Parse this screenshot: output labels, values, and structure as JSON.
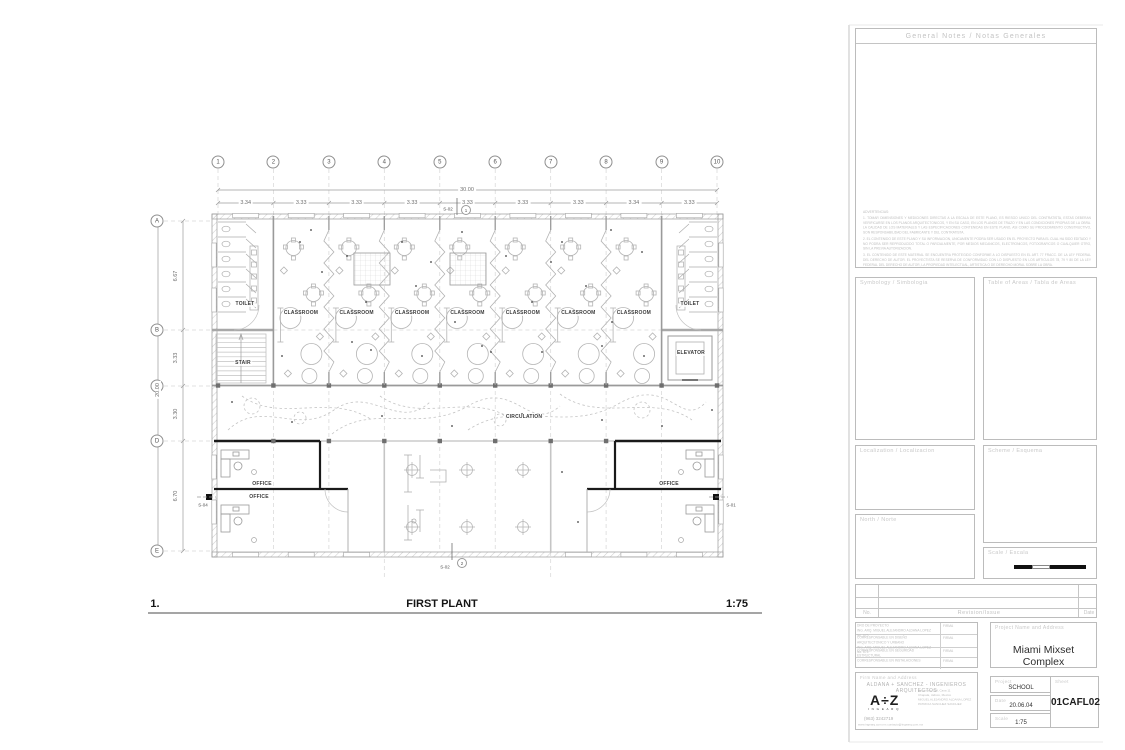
{
  "plan": {
    "grid_columns": [
      "1",
      "2",
      "3",
      "4",
      "5",
      "6",
      "7",
      "8",
      "9",
      "10"
    ],
    "grid_rows": [
      "A",
      "B",
      "C",
      "D",
      "E"
    ],
    "dims": {
      "total_width": "30.00",
      "segments_top": [
        "3.34",
        "3.33",
        "3.33",
        "3.33",
        "3.33",
        "3.33",
        "3.33",
        "3.34",
        "3.33"
      ],
      "total_height": "20.00",
      "segments_left": [
        "6.67",
        "3.33",
        "3.30",
        "6.70"
      ]
    },
    "rooms": {
      "toilet": "TOILET",
      "classroom": "CLASSROOM",
      "stair": "STAIR",
      "elevator": "ELEVATOR",
      "circulation": "CIRCULATION",
      "office": "OFFICE"
    },
    "markers": {
      "section_top": "S-02",
      "section_top_no": "1",
      "section_bottom": "S-02",
      "section_bottom_no": "2",
      "section_left": "S-04",
      "section_right": "S-01"
    },
    "caption": {
      "number": "1.",
      "title": "FIRST PLANT",
      "scale": "1:75"
    }
  },
  "titleblock": {
    "general_notes_header": "General Notes / Notas Generales",
    "advertencias_title": "ADVERTENCIAS:",
    "advertencias": [
      "1.  TOMAR DIMENSIONES Y MEDICIONES DIRECTAS A LA ESCALA DE ESTE PLANO, ES RIESGO UNICO DEL CONTRATISTA, ESTAS DEBERAN VERIFICARSE EN LOS PLANOS ARQUITECTONICOS, Y EN SU CASO, EN LOS PLANOS DE TRAZO Y EN LAS CONDICIONES PROPIAS DE LA OBRA. LA CALIDAD DE LOS MATERIALES Y LAS ESPECIFICACIONES CONTENIDAS EN ESTE PLANO, ASI COMO SU PROCEDIMIENTO CONSTRUCTIVO, SON RESPONSABILIDAD DEL FABRICANTE Y DEL CONTRATISTA.",
      "2.  EL CONTENIDO DE ESTE PLANO Y SU INFORMACION, UNICAMENTE PODRA SER USADO EN EL PROYECTO PARA EL CUAL HA SIDO EDITADO Y NO PODRA SER REPRODUCIDO TOTAL O PARCIALMENTE, POR MEDIOS MECANICOS, ELECTRONICOS, FOTOGRAFICOS O CUALQUIER OTRO, SIN LA PREVIA AUTORIZACION.",
      "3.  EL CONTENIDO DE ESTE MATERIAL SE ENCUENTRA PROTEGIDO CONFORME A LO DISPUESTO EN EL ART. 77 FRACC. DE LA LEY FEDERAL DEL DERECHO DE AUTOR. EL PROYECTISTA SE RESERVA DE CONFORMIDAD CON LO DISPUESTO EN LOS ARTICULOS 78, 79 Y 80 DE LA LEY FEDERAL DEL DERECHO DE AUTOR, LA PROPIEDAD INTELECTUAL, ARTISTICA O DE DERECHO MORAL SOBRE LA OBRA."
    ],
    "symbology_label": "Symbology / Simbologia",
    "areas_label": "Table of Areas / Tabla de Areas",
    "localization_label": "Localization / Localizacion",
    "scheme_label": "Scheme / Esquema",
    "north_label": "North / Norte",
    "scale_box_label": "Scale / Escala",
    "revision": {
      "no": "No.",
      "issue": "Revision/Issue",
      "date": "Date"
    },
    "firma_label": "FIRMA",
    "responsables": [
      {
        "role": "DRO DE PROYECTO",
        "name": "ING. ARQ. MIGUEL ALEJANDRO ALDANA LOPEZ",
        "reg": "No. 675"
      },
      {
        "role": "CORRESPONSABLE EN DISEÑO ARQUITECTONICO Y URBANO",
        "name": "ING. ARQ. MIGUEL ALEJANDRO ALDANA LOPEZ",
        "reg": "No. 675"
      },
      {
        "role": "CORRESPONSABLE EN SEGURIDAD ESTRUCTURAL",
        "name": "",
        "reg": ""
      },
      {
        "role": "CORRESPONSABLE EN INSTALACIONES",
        "name": "",
        "reg": ""
      }
    ],
    "project_name_label": "Project Name and Address",
    "project_name": "Miami Mixset Complex",
    "firm_label": "Firm Name and Address",
    "firm_name": "ALDANA + SANCHEZ - INGENIEROS ARQUITECTOS",
    "firm_logo": "A÷Z",
    "firm_logo_sub": "I N G E A R Q",
    "firm_address": [
      "Tamarindo 108, Casa 11",
      "Chapala, Jalisco, Mexico",
      "MIGUEL ALEJANDRO ALDANA LOPEZ",
      "PATRICIA SANCHEZ SANCHEZ"
    ],
    "firm_phone": "(963) 3242719",
    "firm_web": "www.ingearq.com.mx  contacto@ingearq.com.mx",
    "info": {
      "project_label": "Project",
      "project": "SCHOOL",
      "date_label": "Date",
      "date": "20.06.04",
      "scale_label": "Scale",
      "scale": "1:75",
      "sheet_label": "Sheet",
      "sheet": "01CAFL02"
    }
  }
}
